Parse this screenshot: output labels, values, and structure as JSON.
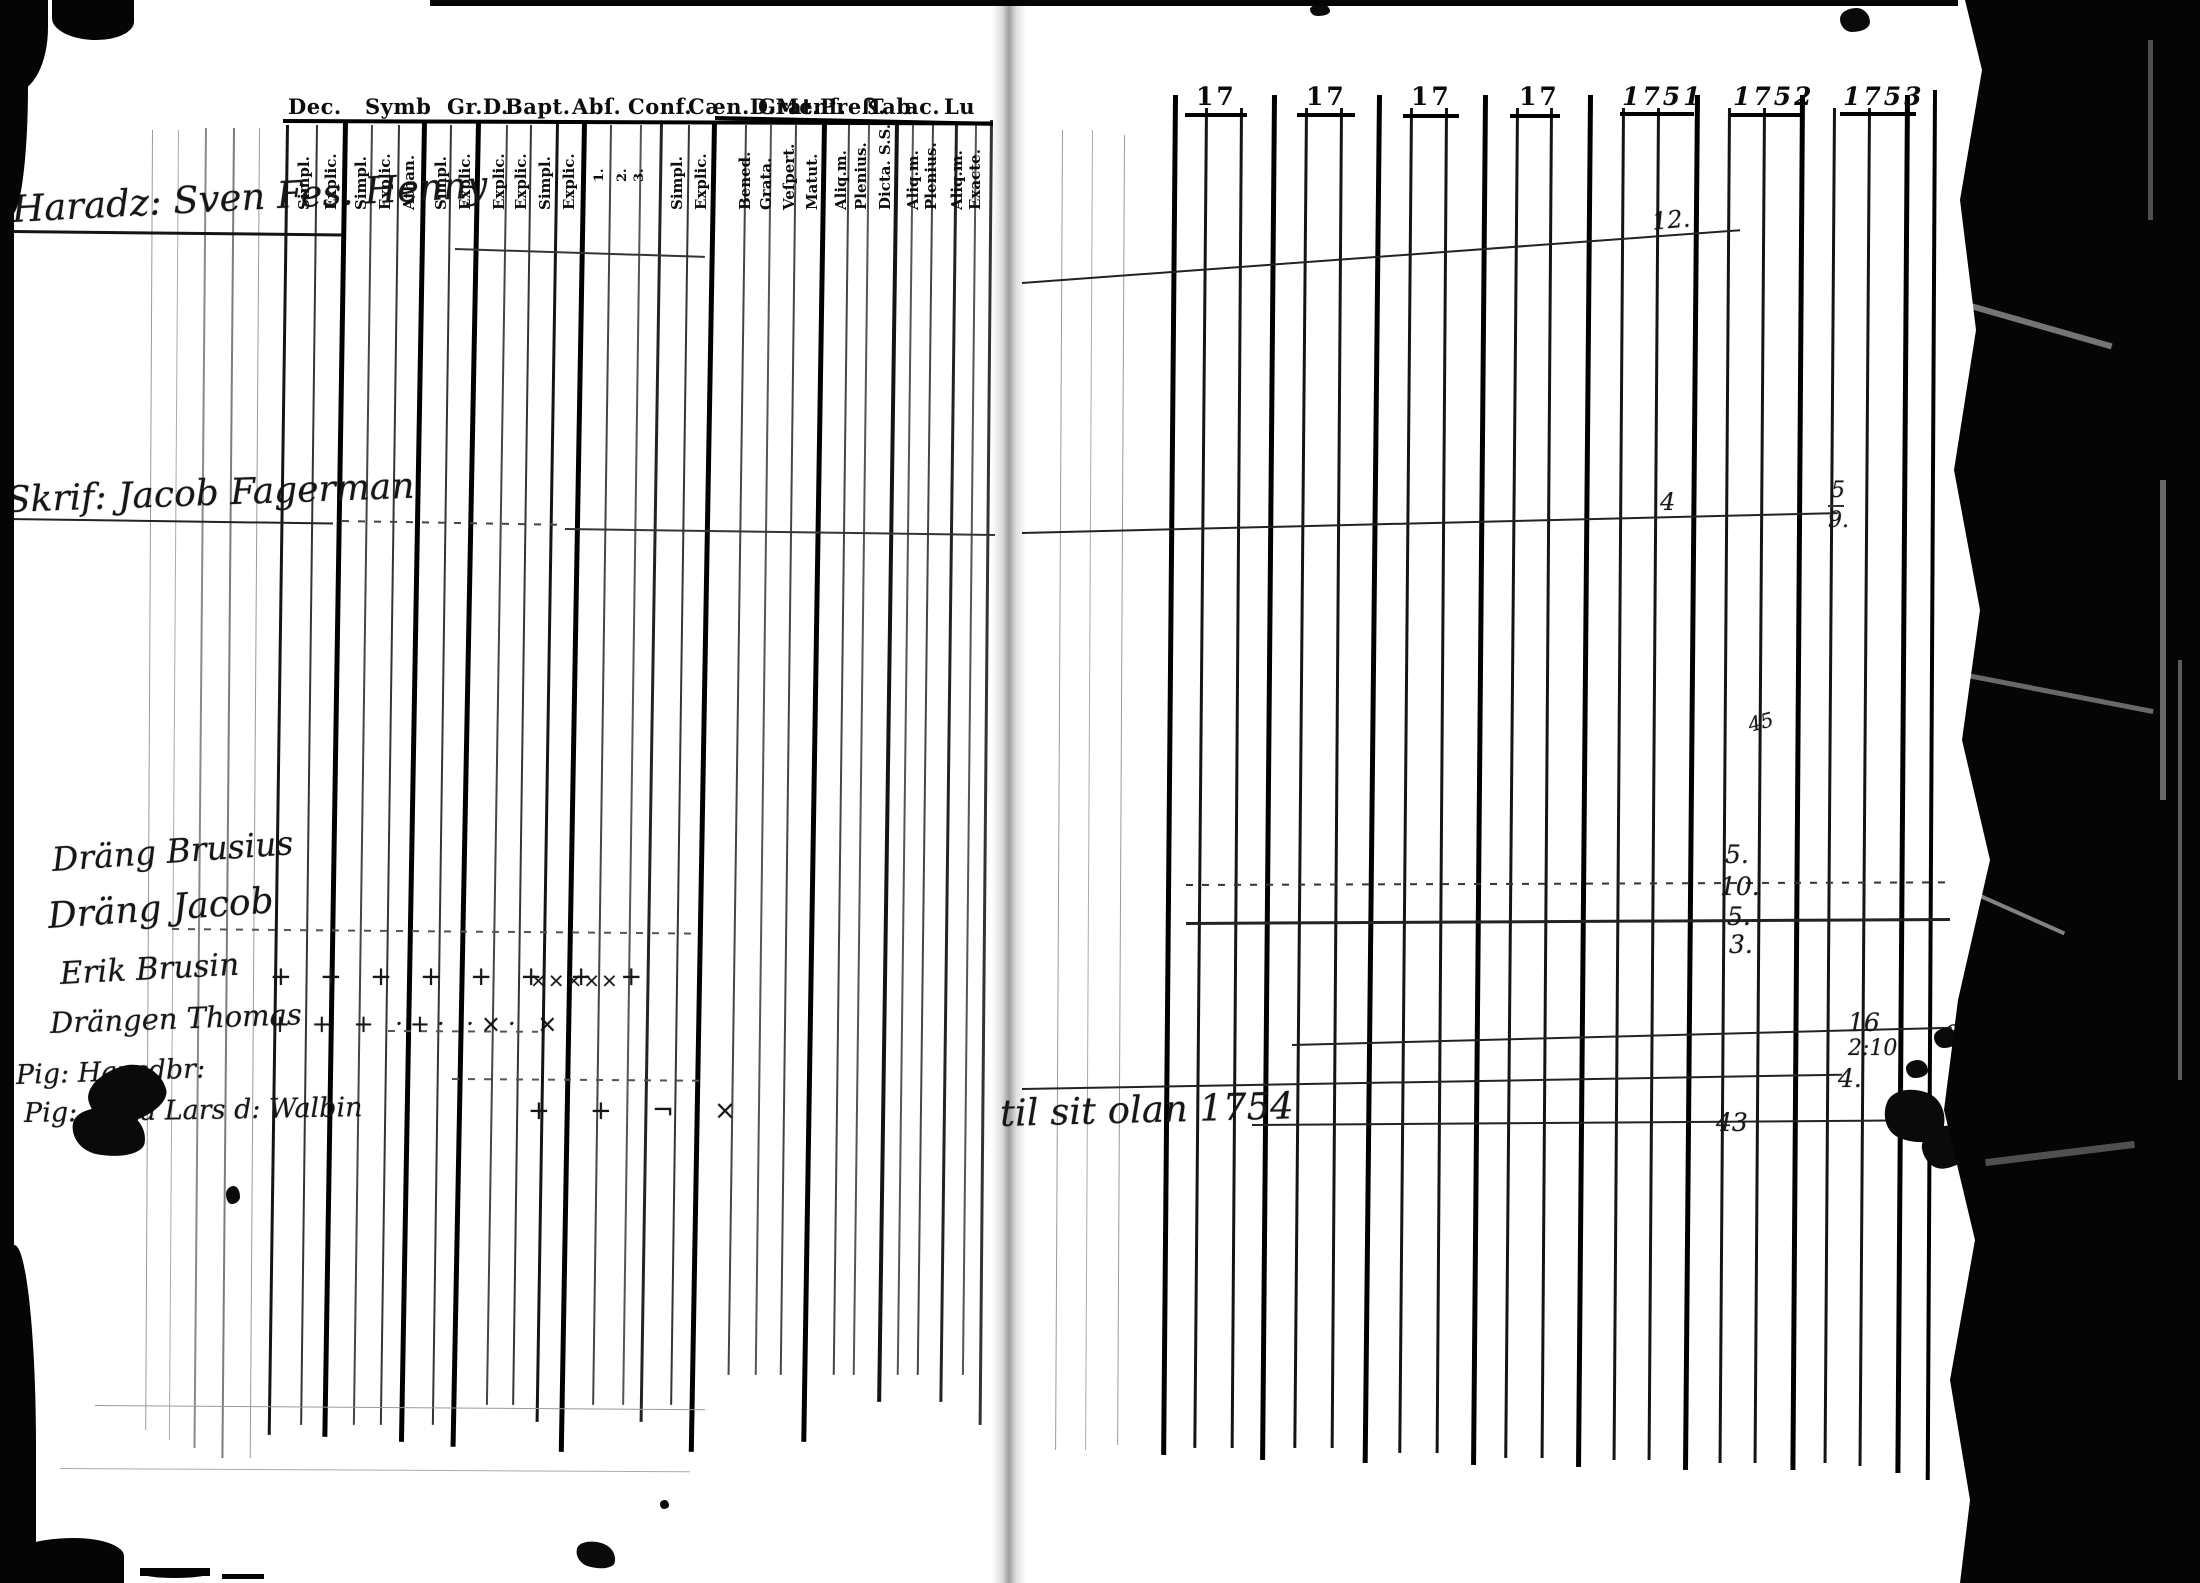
{
  "left_page": {
    "header": [
      "Dec.",
      "Symb",
      "Gr.D.",
      "Bapt.",
      "Abſ.",
      "Conf.",
      "Cæn.D.Menſ.",
      "Grat.",
      "Preß.",
      "Tab",
      "ac.",
      "Lu"
    ],
    "column_labels": [
      "Simpl.",
      "Explic.",
      "Simpl.",
      "Explic.",
      "Athan.",
      "Simpl.",
      "Explic.",
      "Explic.",
      "Explic.",
      "Simpl.",
      "Explic.",
      "1.",
      "2.",
      "3.",
      "Simpl.",
      "Explic.",
      "Bened.",
      "Grata.",
      "Veſpert.",
      "Matut.",
      "Aliq.m.",
      "Plenius.",
      "Dicta. S.S.",
      "Aliq.m.",
      "Plenius.",
      "Aliq.m.",
      "Exacte."
    ],
    "entries": [
      {
        "name": "Haradz: Sven Fes. Henny"
      },
      {
        "name": "Skrif: Jacob Fagerman"
      },
      {
        "name": "Dräng Brusius"
      },
      {
        "name": "Dräng Jacob"
      },
      {
        "name": "Erik Brusin",
        "marks": "+ + + + + + + +",
        "marks2": "×××××"
      },
      {
        "name": "Drängen Thomas",
        "marks": "+ + + ·+· ·×· ×"
      },
      {
        "name": "Pig: Hansdbr:"
      },
      {
        "name": "Pig: Anna Lars d: Walbin",
        "marks": "+ + ¬ ×"
      }
    ]
  },
  "right_page": {
    "years": [
      "17",
      "17",
      "17",
      "17",
      "1751",
      "1752",
      "1753"
    ],
    "note": "til sit olan 1754",
    "annotations": [
      {
        "text": "12."
      },
      {
        "text": "4"
      },
      {
        "text": "5"
      },
      {
        "text": "9."
      },
      {
        "text": "45"
      },
      {
        "text": "5."
      },
      {
        "text": "10."
      },
      {
        "text": "5."
      },
      {
        "text": "3."
      },
      {
        "text": "16"
      },
      {
        "text": "2:10"
      },
      {
        "text": "4."
      },
      {
        "text": "43"
      },
      {
        "text": "6."
      }
    ]
  }
}
